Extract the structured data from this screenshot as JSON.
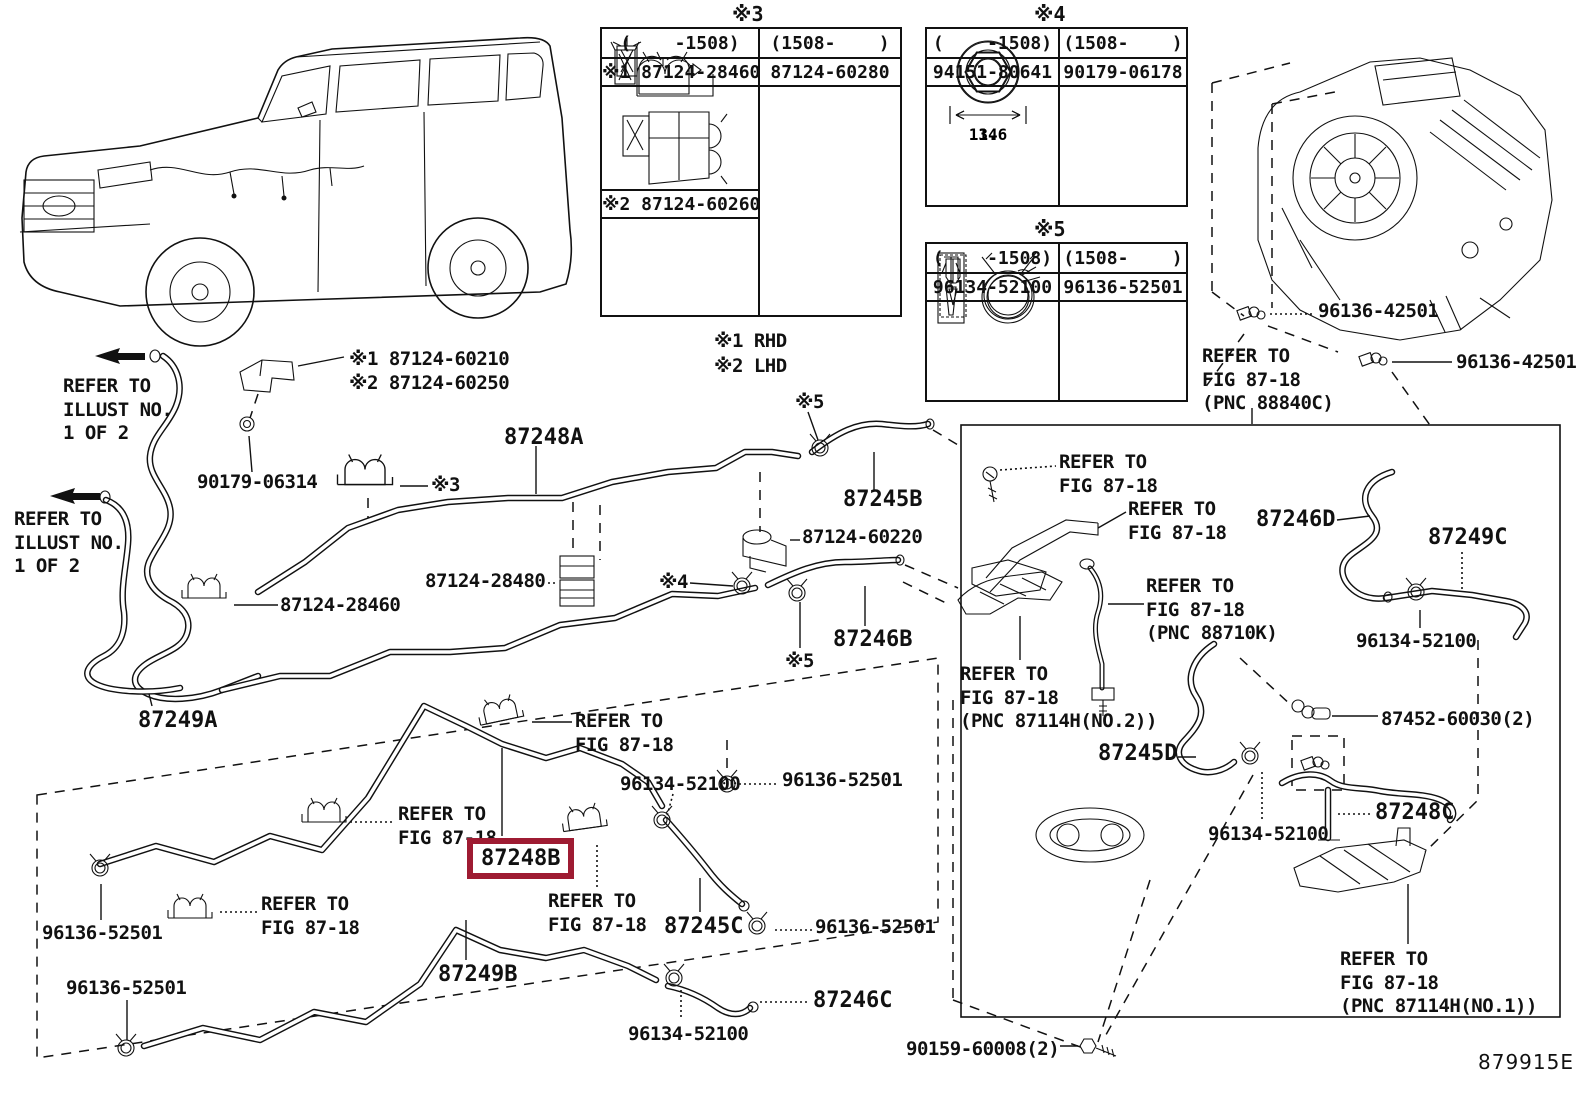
{
  "accent_color": "#9e1b32",
  "doc_number": "879915E",
  "notes": {
    "rhd": "※1 RHD",
    "lhd": "※2 LHD"
  },
  "tables": {
    "t3": {
      "title": "※3",
      "header_left": "(    -1508)",
      "header_right": "(1508-    )",
      "part_left_1": "※1 87124-28460",
      "part_right": "87124-60280",
      "part_left_2": "※2 87124-60260"
    },
    "t4": {
      "title": "※4",
      "header_left": "(    -1508)",
      "header_right": "(1508-    )",
      "part_left": "94151-80641",
      "part_right": "90179-06178",
      "dim_left": "13.6",
      "dim_right": "14"
    },
    "t5": {
      "title": "※5",
      "header_left": "(    -1508)",
      "header_right": "(1508-    )",
      "part_left": "96134-52100",
      "part_right": "96136-52501"
    }
  },
  "labels": {
    "refer_illust_a": "REFER TO\nILLUST NO.\n1 OF 2",
    "refer_illust_b": "REFER TO\nILLUST NO.\n1 OF 2",
    "pn_60210_60250": "※1 87124-60210\n※2 87124-60250",
    "pn_90179_06314": "90179-06314",
    "ref3": "※3",
    "pn_87248A": "87248A",
    "ref5a": "※5",
    "pn_87245B": "87245B",
    "pn_60220": "87124-60220",
    "pn_28480": "87124-28480",
    "ref4": "※4",
    "pn_87246B": "87246B",
    "ref5b": "※5",
    "pn_28460": "87124-28460",
    "pn_87249A": "87249A",
    "refer_fig_a": "REFER TO\nFIG 87-18",
    "pn_96134_a": "96134-52100",
    "refer_fig_b": "REFER TO\nFIG 87-18",
    "pn_87248B": "87248B",
    "pn_96136_a": "96136-52501",
    "refer_fig_c": "REFER TO\nFIG 87-18",
    "pn_87245C": "87245C",
    "pn_96136_b": "96136-52501",
    "pn_96136_c": "96136-52501",
    "refer_fig_d": "REFER TO\nFIG 87-18",
    "pn_96136_d": "96136-52501",
    "pn_87249B": "87249B",
    "pn_96134_b": "96134-52100",
    "pn_87246C": "87246C",
    "pn_90159": "90159-60008(2)",
    "refer_fig_88840": "REFER TO\nFIG 87-18\n(PNC 88840C)",
    "pn_42501_a": "96136-42501",
    "pn_42501_b": "96136-42501",
    "refer_fig_e": "REFER TO\nFIG 87-18",
    "refer_fig_f": "REFER TO\nFIG 87-18",
    "pn_87246D": "87246D",
    "refer_fig_88710": "REFER TO\nFIG 87-18\n(PNC 88710K)",
    "pn_87249C": "87249C",
    "pn_96134_c": "96134-52100",
    "refer_fig_87114_2": "REFER TO\nFIG 87-18\n(PNC 87114H(NO.2))",
    "pn_87245D": "87245D",
    "pn_87452": "87452-60030(2)",
    "pn_96134_d": "96134-52100",
    "pn_87248C": "87248C",
    "refer_fig_87114_1": "REFER TO\nFIG 87-18\n(PNC 87114H(NO.1))"
  }
}
